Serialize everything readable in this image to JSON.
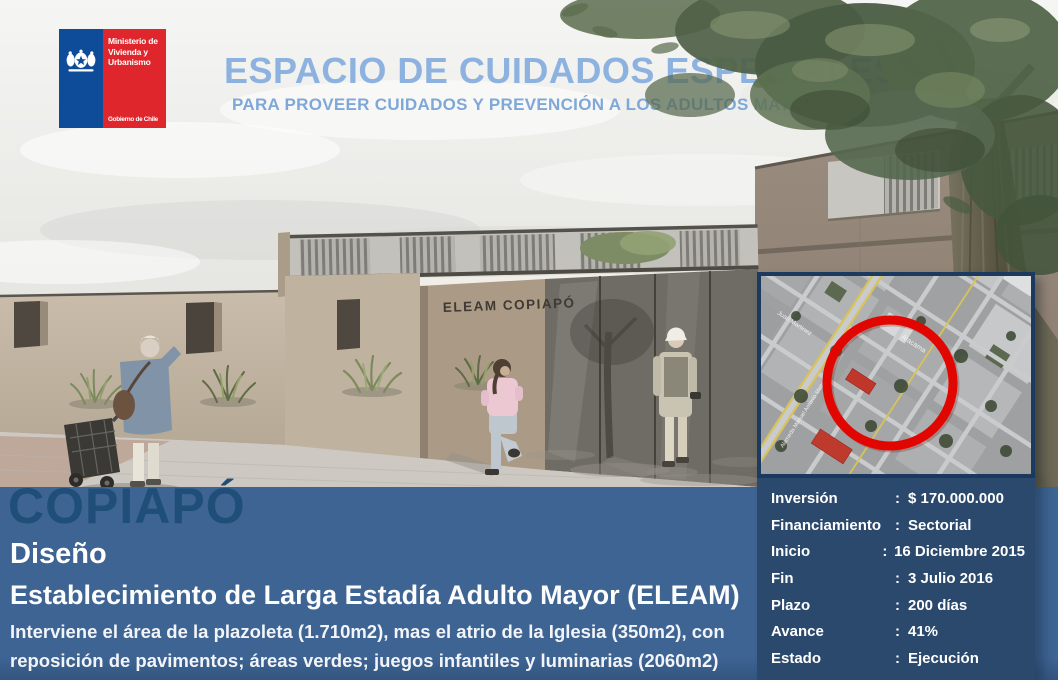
{
  "header": {
    "title": "ESPACIO DE CUIDADOS ESPECIALES",
    "subtitle": "PARA PROVEER CUIDADOS Y PREVENCIÓN A LOS ADULTOS MAYORES"
  },
  "logo": {
    "ministry": "Ministerio de Vivienda y Urbanismo",
    "government": "Gobierno de Chile"
  },
  "render": {
    "building_sign": "ELEAM COPIAPÓ"
  },
  "map": {
    "streets": {
      "street1": "Juan Martinez",
      "street2": "Alameda Manuel Antonio Matta",
      "street3": "Atacama"
    },
    "highlight_color": "#E10600"
  },
  "project": {
    "city": "COPIAPÓ",
    "stage": "Diseño",
    "name": "Establecimiento de Larga Estadía Adulto Mayor (ELEAM)",
    "description": "Interviene el área de la plazoleta (1.710m2), mas el atrio de la Iglesia (350m2), con reposición de pavimentos; áreas verdes; juegos infantiles y luminarias (2060m2)"
  },
  "panel": {
    "colon": ":",
    "rows": [
      {
        "label": "Inversión",
        "value": "$ 170.000.000"
      },
      {
        "label": "Financiamiento",
        "value": "Sectorial"
      },
      {
        "label": "Inicio",
        "value": "16 Diciembre 2015"
      },
      {
        "label": "Fin",
        "value": "3 Julio 2016"
      },
      {
        "label": "Plazo",
        "value": "200 días"
      },
      {
        "label": "Avance",
        "value": "41%"
      },
      {
        "label": "Estado",
        "value": "Ejecución"
      }
    ]
  },
  "colors": {
    "band_blue": "#3E6494",
    "panel_navy": "#2B496C",
    "city_blue": "#1F4E79",
    "title_blue": "#8EB2E0",
    "logo_red": "#E0262D",
    "logo_blue": "#0E4C9A"
  }
}
